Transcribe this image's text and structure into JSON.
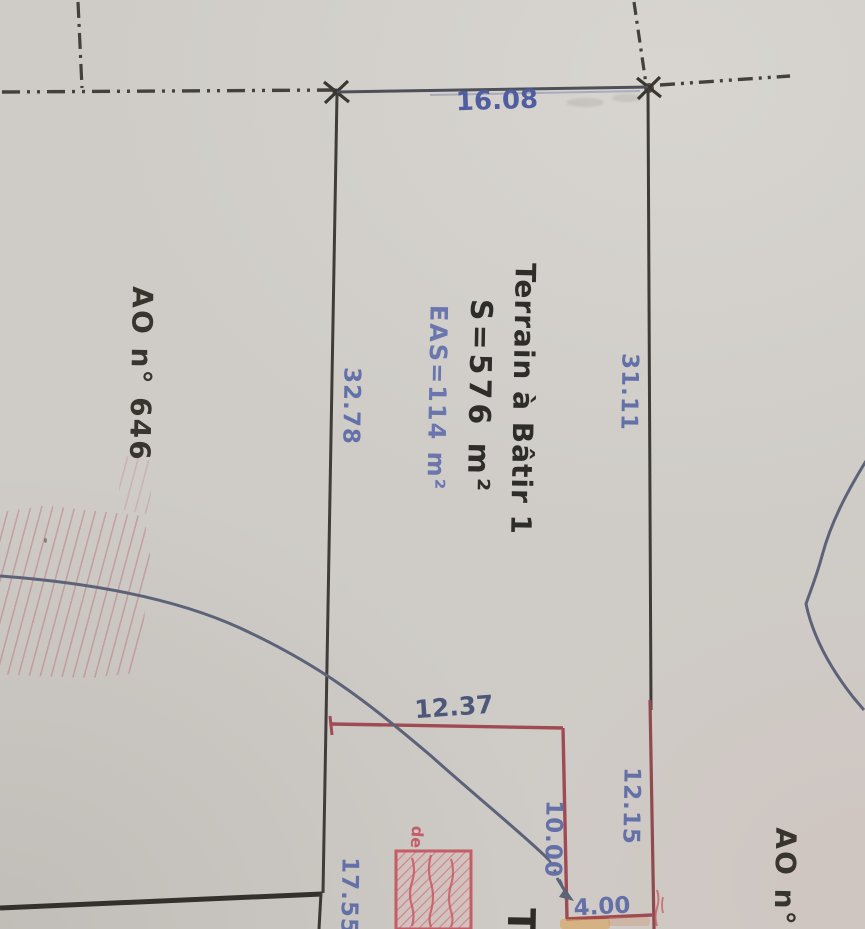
{
  "plan": {
    "parcel_1": {
      "title": "Terrain à Bâtir 1",
      "surface": "S=576 m²",
      "eas": "EAS=114 m²"
    },
    "adjacent_left": {
      "label": "AO n° 646"
    },
    "adjacent_bottom_right": {
      "label": "AO n°"
    },
    "parcel_2_partial": {
      "label": "T"
    },
    "measurements": {
      "top_boundary": "16.08",
      "left_boundary": "32.78",
      "right_boundary": "31.11",
      "red_top": "12.37",
      "red_right_outer": "12.15",
      "red_right_inner": "10.00",
      "red_bottom": "4.00",
      "bottom_left_boundary": "17.55"
    },
    "stamp": {
      "visible_text": "de"
    },
    "colors": {
      "paper": "#cfccc7",
      "ink_black": "#3b3833",
      "ink_blue": "#6470a8",
      "ink_red": "#a04b53",
      "stamp_red": "#c4525c",
      "curve_blue": "#5c6378",
      "title_ink": "#2f2d29"
    }
  }
}
